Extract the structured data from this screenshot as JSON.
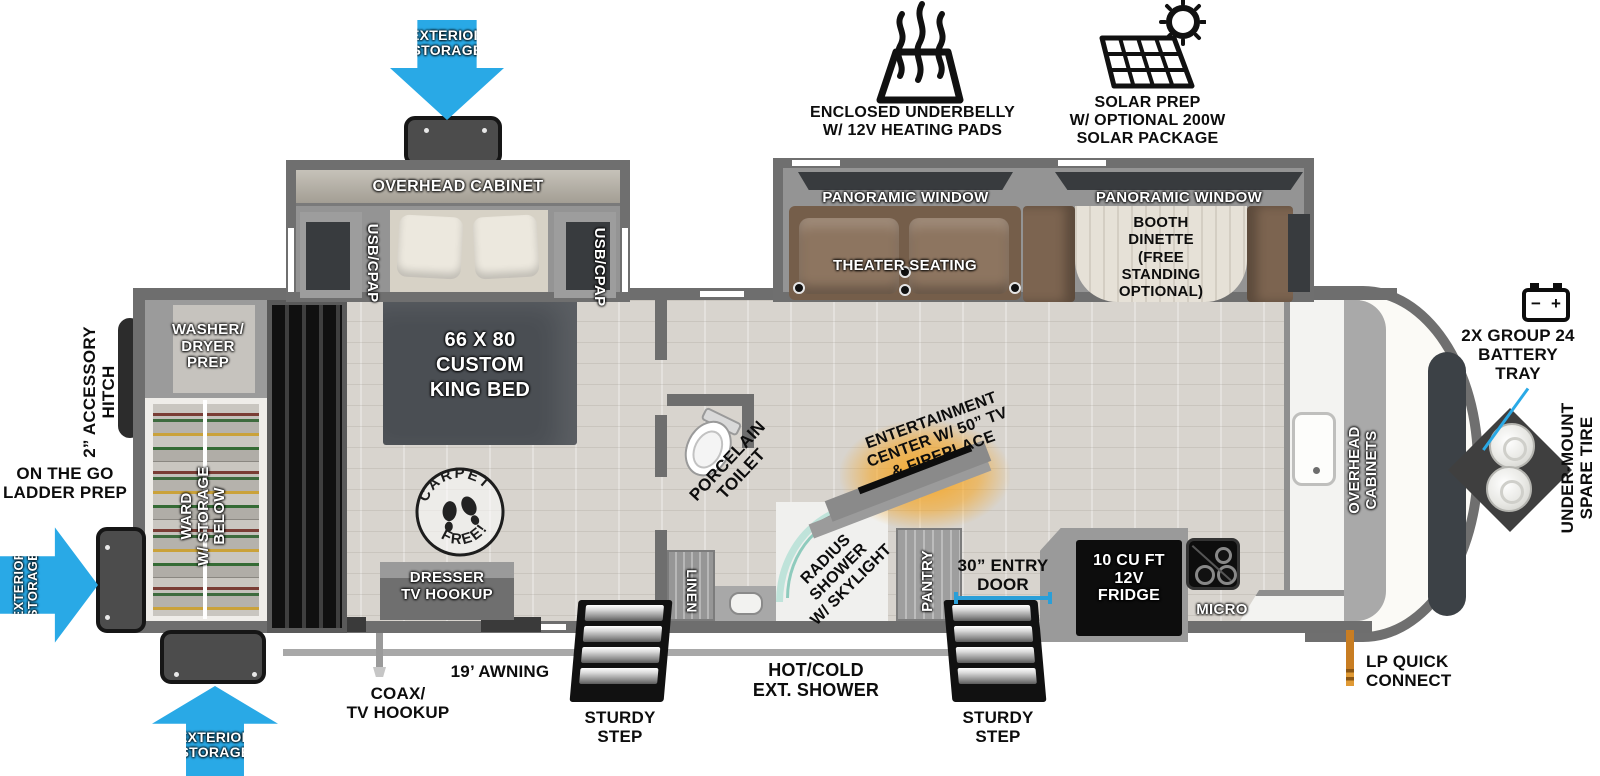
{
  "colors": {
    "accent_blue": "#29a9e6",
    "glow_orange": "#f7a41d",
    "wall_gray": "#6e6e6e",
    "bed_gray": "#4a4e53",
    "sofa_brown": "#7c6450"
  },
  "callouts": {
    "underbelly": {
      "line1": "ENCLOSED UNDERBELLY",
      "line2": "W/ 12V HEATING PADS"
    },
    "solar": {
      "line1": "SOLAR PREP",
      "line2": "W/ OPTIONAL 200W",
      "line3": "SOLAR PACKAGE"
    },
    "battery": {
      "minus": "−",
      "plus": "+",
      "line1": "2X GROUP 24",
      "line2": "BATTERY",
      "line3": "TRAY"
    },
    "spare_tire": {
      "line1": "UNDER-MOUNT",
      "line2": "SPARE TIRE"
    },
    "lp": {
      "line1": "LP QUICK",
      "line2": "CONNECT"
    },
    "hitch": {
      "line1": "2” ACCESSORY",
      "line2": "HITCH"
    },
    "ladder": {
      "line1": "ON THE GO",
      "line2": "LADDER PREP"
    },
    "awning": "19’ AWNING",
    "coax": {
      "line1": "COAX/",
      "line2": "TV HOOKUP"
    },
    "ext_shower": {
      "line1": "HOT/COLD",
      "line2": "EXT. SHOWER"
    },
    "entry_door": {
      "line1": "30” ENTRY",
      "line2": "DOOR"
    },
    "step_left": {
      "line1": "STURDY",
      "line2": "STEP"
    },
    "step_right": {
      "line1": "STURDY",
      "line2": "STEP"
    },
    "storage_top": {
      "line1": "EXTERIOR",
      "line2": "STORAGE"
    },
    "storage_left": {
      "line1": "EXTERIOR",
      "line2": "STORAGE"
    },
    "storage_bottom": {
      "line1": "EXTERIOR",
      "line2": "STORAGE"
    }
  },
  "bedroom": {
    "overhead_cabinet": "OVERHEAD CABINET",
    "usb_left": "USB/CPAP",
    "usb_right": "USB/CPAP",
    "bed": {
      "line1": "66 X 80",
      "line2": "CUSTOM",
      "line3": "KING BED"
    },
    "dresser": {
      "line1": "DRESSER",
      "line2": "TV HOOKUP"
    },
    "carpet_stamp": {
      "top": "CARPET",
      "bottom": "FREE!"
    },
    "ward": {
      "line1": "WARD",
      "line2": "W/ STORAGE",
      "line3": "BELOW"
    },
    "washer": {
      "line1": "WASHER/",
      "line2": "DRYER",
      "line3": "PREP"
    }
  },
  "living": {
    "window_left": "PANORAMIC WINDOW",
    "window_right": "PANORAMIC WINDOW",
    "theater": "THEATER SEATING",
    "dinette": {
      "line1": "BOOTH",
      "line2": "DINETTE",
      "line3": "(FREE",
      "line4": "STANDING",
      "line5": "OPTIONAL)"
    }
  },
  "bath": {
    "toilet": {
      "line1": "PORCELAIN",
      "line2": "TOILET"
    },
    "linen": "LINEN",
    "shower": {
      "line1": "RADIUS",
      "line2": "SHOWER",
      "line3": "W/ SKYLIGHT"
    }
  },
  "kitchen": {
    "entertainment": {
      "line1": "ENTERTAINMENT",
      "line2": "CENTER W/ 50” TV",
      "line3": "& FIREPLACE"
    },
    "pantry": "PANTRY",
    "fridge": {
      "line1": "10 CU FT",
      "line2": "12V",
      "line3": "FRIDGE"
    },
    "micro": "MICRO",
    "overhead": {
      "line1": "OVERHEAD",
      "line2": "CABINETS"
    }
  }
}
